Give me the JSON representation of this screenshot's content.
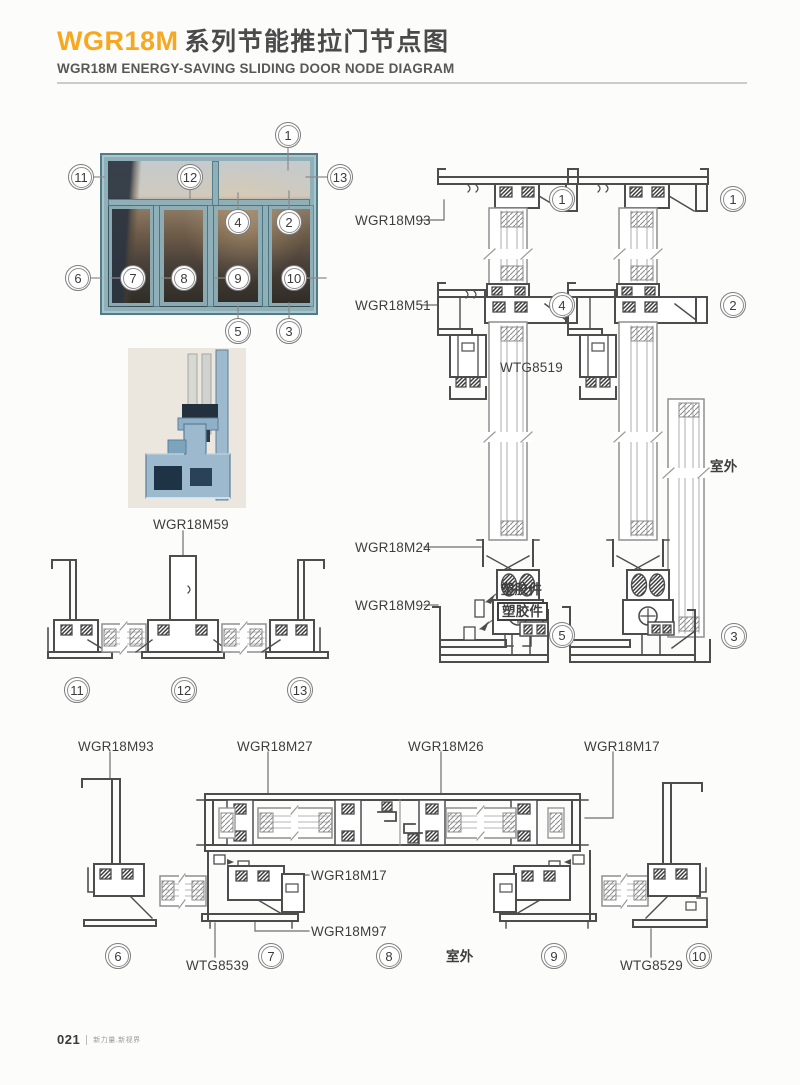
{
  "header": {
    "series": "WGR18M",
    "title_cn": "系列节能推拉门节点图",
    "subtitle_en": "WGR18M ENERGY-SAVING SLIDING DOOR NODE DIAGRAM"
  },
  "colors": {
    "accent_orange": "#F6A821",
    "title_gray": "#4A4A4A",
    "line_dark": "#4D4D4D",
    "frame_teal": "#8FB0B8"
  },
  "callouts": {
    "n1": "1",
    "n2": "2",
    "n3": "3",
    "n4": "4",
    "n5": "5",
    "n6": "6",
    "n7": "7",
    "n8": "8",
    "n9": "9",
    "n10": "10",
    "n11": "11",
    "n12": "12",
    "n13": "13"
  },
  "labels": {
    "wgr18m93": "WGR18M93",
    "wgr18m51": "WGR18M51",
    "wtg8519": "WTG8519",
    "wgr18m24": "WGR18M24",
    "wgr18m92": "WGR18M92",
    "wgr18m59": "WGR18M59",
    "wgr18m27": "WGR18M27",
    "wgr18m26": "WGR18M26",
    "wgr18m17": "WGR18M17",
    "wgr18m97": "WGR18M97",
    "wtg8539": "WTG8539",
    "wtg8529": "WTG8529",
    "plastic_part": "塑胶件",
    "outdoor": "室外"
  },
  "footer": {
    "page_number": "021",
    "tagline": "新力量.新视界"
  }
}
